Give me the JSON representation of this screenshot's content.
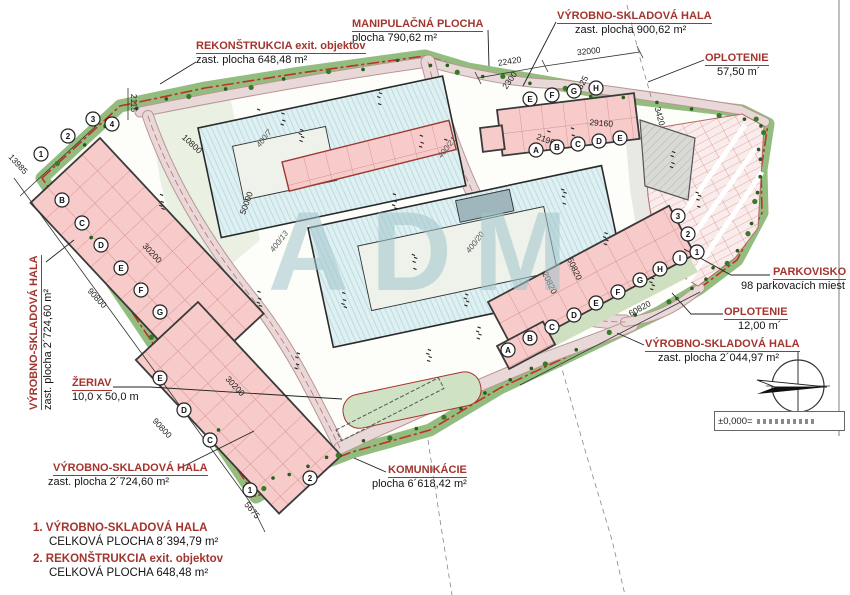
{
  "watermark": "ADM",
  "colors": {
    "label_red": "#a3342e",
    "boundary_red": "#c03028",
    "green_band": "#93bd7e",
    "building_pink": "#f7cbca",
    "hall_blue": "#dff0f2",
    "road": "#e8d8d8"
  },
  "callouts": {
    "rekonstrukcia": {
      "title": "REKONŠTRUKCIA exit. objektov",
      "sub": "zast. plocha 648,48 m²"
    },
    "manipulacna": {
      "title": "MANIPULAČNÁ PLOCHA",
      "sub": "plocha 790,62 m²"
    },
    "hala900": {
      "title": "VÝROBNO-SKLADOVÁ HALA",
      "sub": "zast. plocha 900,62 m²"
    },
    "oplotenie57": {
      "title": "OPLOTENIE",
      "sub": "57,50 m´"
    },
    "parkovisko": {
      "title": "PARKOVISKO",
      "sub": "98 parkovacích miest"
    },
    "oplotenie12": {
      "title": "OPLOTENIE",
      "sub": "12,00 m´"
    },
    "hala2044": {
      "title": "VÝROBNO-SKLADOVÁ HALA",
      "sub": "zast. plocha 2´044,97 m²"
    },
    "hala2724l": {
      "title": "VÝROBNO-SKLADOVÁ HALA",
      "sub": "zast. plocha 2´724,60 m²"
    },
    "zeriav": {
      "title": "ŽERIAV",
      "sub": "10,0 x 50,0 m"
    },
    "hala2724b": {
      "title": "VÝROBNO-SKLADOVÁ HALA",
      "sub": "zast. plocha 2´724,60 m²"
    },
    "komunikacie": {
      "title": "KOMUNIKÁCIE",
      "sub": "plocha 6´618,42 m²"
    }
  },
  "legend": [
    {
      "num": "1.",
      "title": "VÝROBNO-SKLADOVÁ HALA",
      "sub": "CELKOVÁ PLOCHA 8´394,79 m²"
    },
    {
      "num": "2.",
      "title": "REKONŠTRUKCIA exit. objektov",
      "sub": "CELKOVÁ PLOCHA 648,48 m²"
    }
  ],
  "datum_box": "±0,000=",
  "plan": {
    "dimensions": [
      {
        "t": "13985",
        "x": 16,
        "y": 166,
        "r": 47
      },
      {
        "t": "2115",
        "x": 131,
        "y": 103,
        "r": 90
      },
      {
        "t": "22420",
        "x": 510,
        "y": 64,
        "r": -9
      },
      {
        "t": "32000",
        "x": 589,
        "y": 54,
        "r": -6
      },
      {
        "t": "9625",
        "x": 584,
        "y": 86,
        "r": -62
      },
      {
        "t": "2300",
        "x": 512,
        "y": 82,
        "r": -55
      },
      {
        "t": "29160",
        "x": 601,
        "y": 126,
        "r": 4
      },
      {
        "t": "21960",
        "x": 547,
        "y": 143,
        "r": 20
      },
      {
        "t": "3420",
        "x": 657,
        "y": 117,
        "r": 75
      },
      {
        "t": "50000",
        "x": 249,
        "y": 204,
        "r": -70
      },
      {
        "t": "10800",
        "x": 190,
        "y": 146,
        "r": 43
      },
      {
        "t": "30200",
        "x": 150,
        "y": 255,
        "r": 47
      },
      {
        "t": "90800",
        "x": 95,
        "y": 300,
        "r": 47
      },
      {
        "t": "30200",
        "x": 233,
        "y": 388,
        "r": 47
      },
      {
        "t": "90800",
        "x": 160,
        "y": 430,
        "r": 47
      },
      {
        "t": "5675",
        "x": 250,
        "y": 512,
        "r": 50
      },
      {
        "t": "60820",
        "x": 641,
        "y": 311,
        "r": -28
      },
      {
        "t": "50820",
        "x": 572,
        "y": 270,
        "r": 65
      },
      {
        "t": "20820",
        "x": 547,
        "y": 284,
        "r": 65
      }
    ],
    "parcels": [
      {
        "t": "400/7",
        "x": 266,
        "y": 140,
        "r": -52
      },
      {
        "t": "400/13",
        "x": 281,
        "y": 243,
        "r": -52
      },
      {
        "t": "400/21",
        "x": 449,
        "y": 149,
        "r": -52
      },
      {
        "t": "400/20",
        "x": 477,
        "y": 244,
        "r": -52
      }
    ],
    "bubbles": [
      {
        "t": "1",
        "x": 41,
        "y": 154
      },
      {
        "t": "2",
        "x": 68,
        "y": 136
      },
      {
        "t": "3",
        "x": 93,
        "y": 119
      },
      {
        "t": "4",
        "x": 112,
        "y": 124
      },
      {
        "t": "B",
        "x": 62,
        "y": 200
      },
      {
        "t": "C",
        "x": 82,
        "y": 223
      },
      {
        "t": "D",
        "x": 101,
        "y": 245
      },
      {
        "t": "E",
        "x": 121,
        "y": 268
      },
      {
        "t": "F",
        "x": 141,
        "y": 290
      },
      {
        "t": "G",
        "x": 160,
        "y": 312
      },
      {
        "t": "E",
        "x": 530,
        "y": 99
      },
      {
        "t": "F",
        "x": 552,
        "y": 95
      },
      {
        "t": "G",
        "x": 574,
        "y": 91
      },
      {
        "t": "H",
        "x": 596,
        "y": 88
      },
      {
        "t": "A",
        "x": 536,
        "y": 150
      },
      {
        "t": "B",
        "x": 557,
        "y": 147
      },
      {
        "t": "C",
        "x": 578,
        "y": 144
      },
      {
        "t": "D",
        "x": 599,
        "y": 141
      },
      {
        "t": "E",
        "x": 620,
        "y": 138
      },
      {
        "t": "A",
        "x": 508,
        "y": 350
      },
      {
        "t": "B",
        "x": 530,
        "y": 338
      },
      {
        "t": "C",
        "x": 552,
        "y": 327
      },
      {
        "t": "D",
        "x": 574,
        "y": 315
      },
      {
        "t": "E",
        "x": 596,
        "y": 303
      },
      {
        "t": "F",
        "x": 618,
        "y": 292
      },
      {
        "t": "G",
        "x": 640,
        "y": 280
      },
      {
        "t": "H",
        "x": 660,
        "y": 269
      },
      {
        "t": "I",
        "x": 680,
        "y": 258
      },
      {
        "t": "1",
        "x": 697,
        "y": 252
      },
      {
        "t": "2",
        "x": 688,
        "y": 234
      },
      {
        "t": "3",
        "x": 678,
        "y": 216
      },
      {
        "t": "1",
        "x": 250,
        "y": 490
      },
      {
        "t": "2",
        "x": 310,
        "y": 478
      },
      {
        "t": "C",
        "x": 210,
        "y": 440
      },
      {
        "t": "D",
        "x": 184,
        "y": 410
      },
      {
        "t": "E",
        "x": 160,
        "y": 378
      }
    ]
  }
}
